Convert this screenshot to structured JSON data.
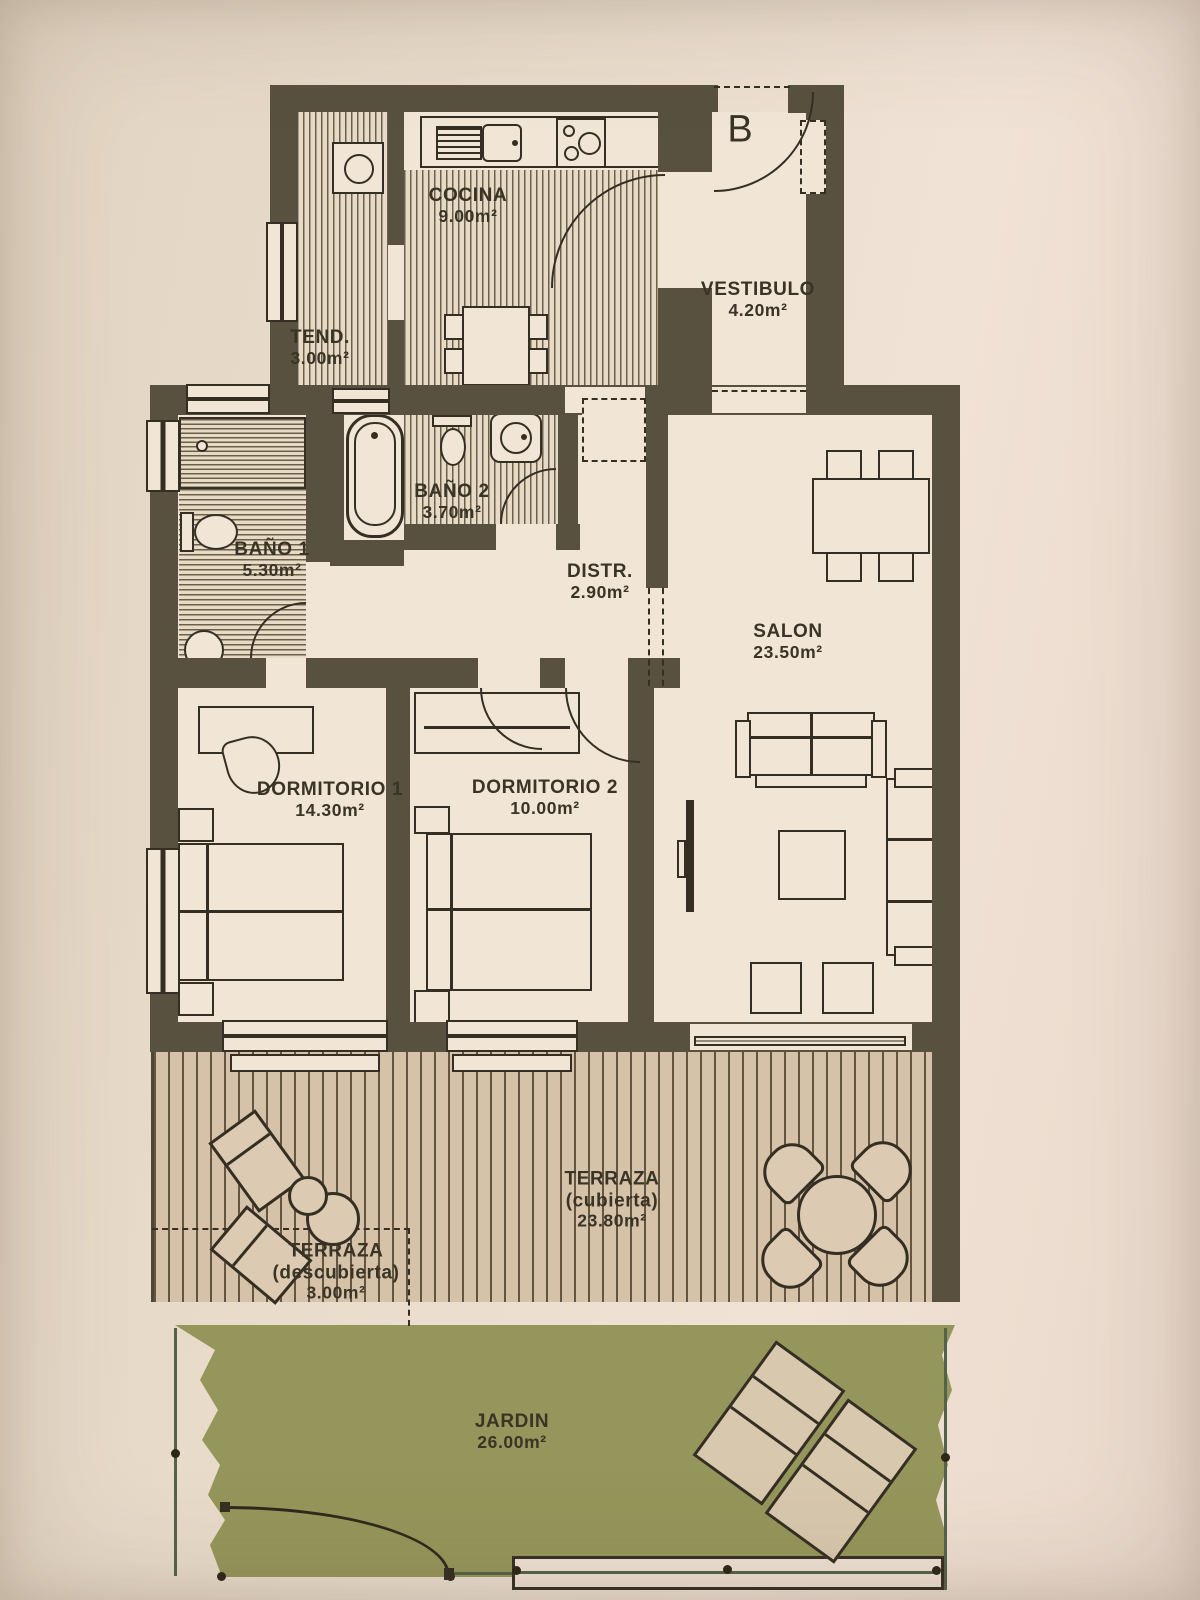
{
  "document": {
    "type": "apartment-floor-plan"
  },
  "entrance": {
    "label": "B"
  },
  "rooms": {
    "cocina": {
      "label": "COCINA",
      "area": "9.00m²"
    },
    "tendedero": {
      "label": "TEND.",
      "area": "3.00m²"
    },
    "vestibulo": {
      "label": "VESTIBULO",
      "area": "4.20m²"
    },
    "bano2": {
      "label": "BAÑO 2",
      "area": "3.70m²"
    },
    "bano1": {
      "label": "BAÑO 1",
      "area": "5.30m²"
    },
    "distribuidor": {
      "label": "DISTR.",
      "area": "2.90m²"
    },
    "salon": {
      "label": "SALON",
      "area": "23.50m²"
    },
    "dormitorio1": {
      "label": "DORMITORIO 1",
      "area": "14.30m²"
    },
    "dormitorio2": {
      "label": "DORMITORIO 2",
      "area": "10.00m²"
    },
    "terraza_cubierta": {
      "label": "TERRAZA",
      "qualifier": "(cubierta)",
      "area": "23.80m²"
    },
    "terraza_descubierta": {
      "label": "TERRAZA",
      "qualifier": "(descubierta)",
      "area": "3.00m²"
    },
    "jardin": {
      "label": "JARDIN",
      "area": "26.00m²"
    }
  },
  "colors": {
    "wall": "#59513F",
    "floor": "#F1E6D5",
    "stripe": "#6B6148",
    "paper": "#E8DBCA",
    "terrace": "#D6C2A9",
    "terraceLine": "#6F6047",
    "terraceChair": "#DCCBB2",
    "garden": "#95965B",
    "outline": "#352F23",
    "text": "#3A3426",
    "fence": "#55624A"
  }
}
